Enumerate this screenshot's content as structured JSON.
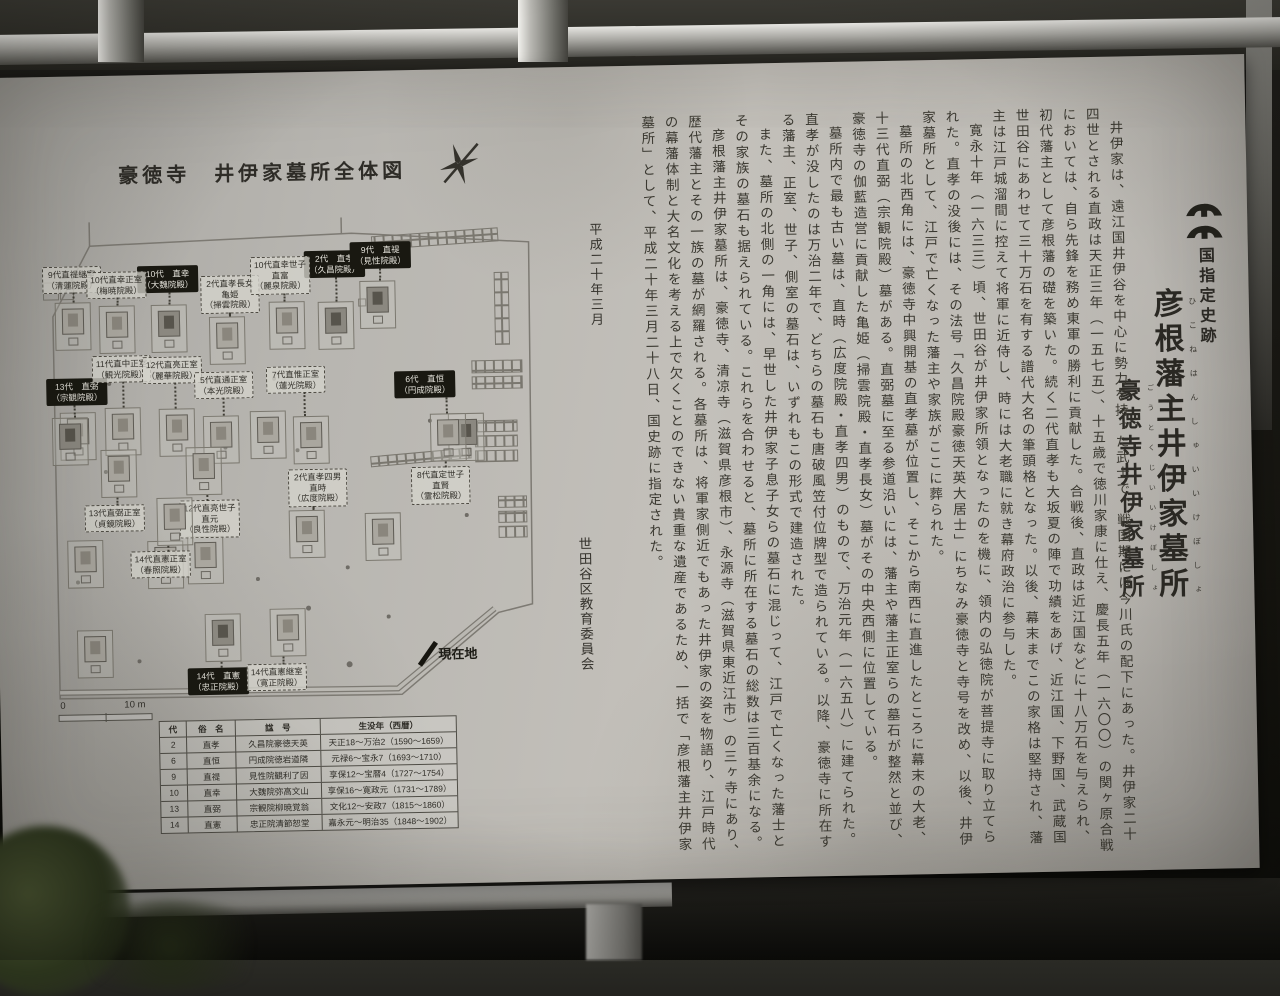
{
  "sign": {
    "designation": "国指定史跡",
    "title": {
      "text": "彦根藩主井伊家墓所",
      "ruby": "ひこねはんしゅいいけぼしょ"
    },
    "subtitle": {
      "text": "豪徳寺井伊家墓所",
      "ruby": "ごうとくじいいけぼしょ"
    },
    "date": "平成二十年三月",
    "author": "世田谷区教育委員会",
    "body": [
      "井伊家は、遠江国井伊谷を中心に勢力を持った武士で、戦国期には今川氏の配下にあった。井伊家二十四世とされる直政は天正三年（一五七五）、十五歳で徳川家康に仕え、慶長五年（一六〇〇）の関ヶ原合戦においては、自ら先鋒を務め東軍の勝利に貢献した。合戦後、直政は近江国などに十八万石を与えられ、初代藩主として彦根藩の礎を築いた。続く二代直孝も大坂夏の陣で功績をあげ、近江国、下野国、武蔵国世田谷にあわせて三十万石を有する譜代大名の筆頭格となった。以後、幕末までこの家格は堅持され、藩主は江戸城溜間に控えて将軍に近侍し、時には大老職に就き幕府政治に参与した。",
      "寛永十年（一六三三）頃、世田谷が井伊家所領となったのを機に、領内の弘徳院が菩提寺に取り立てられた。直孝の没後には、その法号「久昌院殿豪徳天英大居士」にちなみ豪徳寺と寺号を改め、以後、井伊家墓所として、江戸で亡くなった藩主や家族がここに葬られた。",
      "墓所の北西角には、豪徳寺中興開基の直孝墓が位置し、そこから南西に直進したところに幕末の大老、十三代直弼（宗観院殿）墓がある。直弼墓に至る参道沿いには、藩主や藩主正室らの墓石が整然と並び、豪徳寺の伽藍造営に貢献した亀姫（掃雲院殿・直孝長女）墓がその中央西側に位置している。",
      "墓所内で最も古い墓は、直時（広度院殿・直孝四男）のもので、万治元年（一六五八）に建てられた。直孝が没したのは万治二年で、どちらの墓石も唐破風笠付位牌型で造られている。以降、豪徳寺に所在する藩主、正室、世子、側室の墓石は、いずれもこの形式で建造された。",
      "また、墓所の北側の一角には、早世した井伊家子息子女らの墓石に混じって、江戸で亡くなった藩士とその家族の墓石も据えられている。これらを合わせると、墓所に所在する墓石の総数は三百基余になる。",
      "彦根藩主井伊家墓所は、豪徳寺、清凉寺（滋賀県彦根市）、永源寺（滋賀県東近江市）の三ヶ寺にあり、歴代藩主とその一族の墓が網羅される。各墓所は、将軍家側近でもあった井伊家の姿を物語り、江戸時代の幕藩体制と大名文化を考える上で欠くことのできない貴重な遺産であるため、一括で「彦根藩主井伊家墓所」として、平成二十年三月二十八日、国史跡に指定された。"
    ]
  },
  "map": {
    "title": "豪徳寺　井伊家墓所全体図",
    "current_location": "現在地",
    "scale_zero": "0",
    "scale_label": "10 m",
    "labels": [
      {
        "style": "black",
        "x": 2,
        "y": 156,
        "dir": "down",
        "len": 12,
        "dx": -8,
        "lines": [
          "13代　直弼",
          "（宗観院殿）"
        ]
      },
      {
        "style": "black",
        "x": 95,
        "y": 45,
        "dir": "down",
        "len": 12,
        "dx": 0,
        "lines": [
          "10代　直幸",
          "（大魏院殿）"
        ]
      },
      {
        "style": "black",
        "x": 262,
        "y": 33,
        "dir": "down",
        "len": 24,
        "dx": 0,
        "lines": [
          "2代　直孝",
          "（久昌院殿）"
        ]
      },
      {
        "style": "black",
        "x": 308,
        "y": 25,
        "dir": "down",
        "len": 12,
        "dx": -4,
        "lines": [
          "9代　直禔",
          "（見性院殿）"
        ]
      },
      {
        "style": "black",
        "x": 350,
        "y": 155,
        "dir": "down",
        "len": 16,
        "dx": 40,
        "lines": [
          "6代　直恒",
          "（円成院殿）"
        ]
      },
      {
        "style": "black",
        "x": 138,
        "y": 448,
        "dir": "up",
        "len": 6,
        "dx": 5,
        "lines": [
          "14代　直憲",
          "（忠正院殿）"
        ]
      },
      {
        "style": "dashed",
        "x": 0,
        "y": 44,
        "dir": "down",
        "len": 10,
        "dx": 0,
        "lines": [
          "9代直禔継室",
          "（清蓮院殿）"
        ]
      },
      {
        "style": "dashed",
        "x": 44,
        "y": 50,
        "dir": "down",
        "len": 8,
        "dx": 0,
        "lines": [
          "10代直幸正室",
          "（梅暁院殿）"
        ]
      },
      {
        "style": "dashed",
        "x": 158,
        "y": 56,
        "dir": "down",
        "len": 4,
        "dx": -4,
        "lines": [
          "2代直孝長女",
          "亀姫",
          "（掃雲院殿）"
        ]
      },
      {
        "style": "dashed",
        "x": 208,
        "y": 38,
        "dir": "down",
        "len": 8,
        "dx": 6,
        "lines": [
          "10代直幸世子",
          "直富",
          "（麗泉院殿）"
        ]
      },
      {
        "style": "dashed",
        "x": 48,
        "y": 134,
        "dir": "down",
        "len": 26,
        "dx": 0,
        "lines": [
          "11代直中正室",
          "（観光院殿）"
        ]
      },
      {
        "style": "dashed",
        "x": 98,
        "y": 136,
        "dir": "down",
        "len": 26,
        "dx": 4,
        "lines": [
          "12代直亮正室",
          "（麗華院殿）"
        ]
      },
      {
        "style": "dashed",
        "x": 222,
        "y": 148,
        "dir": "down",
        "len": 24,
        "dx": 14,
        "lines": [
          "7代直惟正室",
          "（蓮光院殿）"
        ]
      },
      {
        "style": "dashed",
        "x": 150,
        "y": 152,
        "dir": "down",
        "len": 18,
        "dx": -4,
        "lines": [
          "5代直通正室",
          "（本光院殿）"
        ]
      },
      {
        "style": "dashed",
        "x": 242,
        "y": 251,
        "dir": "down",
        "len": 4,
        "dx": -12,
        "lines": [
          "2代直孝四男",
          "直時",
          "（広度院殿）"
        ]
      },
      {
        "style": "dashed",
        "x": 365,
        "y": 251,
        "dir": "up",
        "len": 6,
        "dx": 8,
        "lines": [
          "8代直定世子",
          "直賢",
          "（霊松院殿）"
        ]
      },
      {
        "style": "dashed",
        "x": 38,
        "y": 283,
        "dir": "up",
        "len": 8,
        "dx": 5,
        "lines": [
          "13代直弼正室",
          "（貞鏡院殿）"
        ]
      },
      {
        "style": "dashed",
        "x": 133,
        "y": 280,
        "dir": "up",
        "len": 6,
        "dx": -5,
        "lines": [
          "12代直亮世子",
          "直元",
          "（良性院殿）"
        ]
      },
      {
        "style": "dashed",
        "x": 83,
        "y": 330,
        "dir": "up",
        "len": 6,
        "dx": 15,
        "lines": [
          "14代直憲正室",
          "（春照院殿）"
        ]
      },
      {
        "style": "dashed",
        "x": 197,
        "y": 445,
        "dir": "up",
        "len": 8,
        "dx": 12,
        "lines": [
          "14代直憲継室",
          "（寛正院殿）"
        ]
      }
    ]
  },
  "table": {
    "headers": [
      "代",
      "俗　名",
      "諡　号",
      "生没年（西暦）"
    ],
    "rows": [
      [
        "2",
        "直孝",
        "久昌院豪徳天英",
        "天正18～万治2（1590～1659）"
      ],
      [
        "6",
        "直恒",
        "円成院徳岩道隣",
        "元禄6～宝永7（1693～1710）"
      ],
      [
        "9",
        "直禔",
        "見性院観利了因",
        "享保12～宝暦4（1727～1754）"
      ],
      [
        "10",
        "直幸",
        "大魏院弥高文山",
        "享保16～寛政元（1731～1789）"
      ],
      [
        "13",
        "直弼",
        "宗観院柳暁覚翁",
        "文化12～安政7（1815～1860）"
      ],
      [
        "14",
        "直憲",
        "忠正院清節恕堂",
        "嘉永元～明治35（1848～1902）"
      ]
    ]
  }
}
